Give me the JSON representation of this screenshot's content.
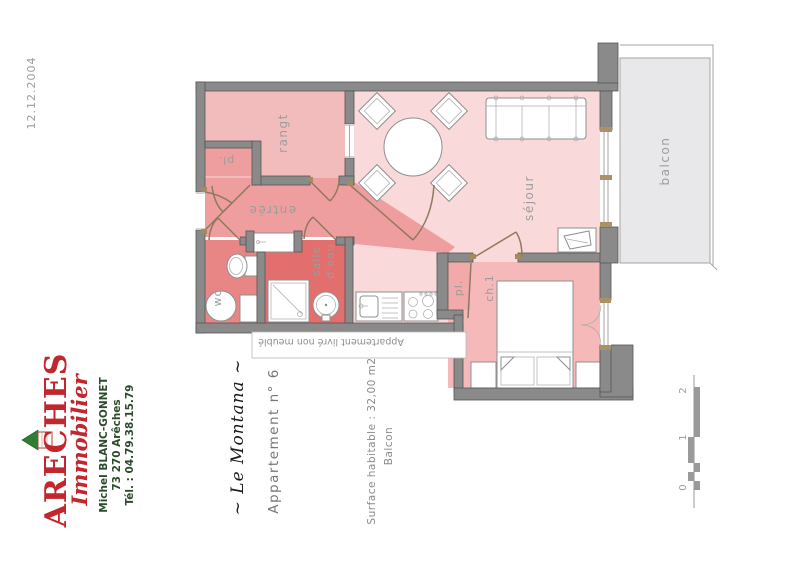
{
  "document": {
    "date": "12.12.2004",
    "delivery_note": "Appartement livré non meublé"
  },
  "agency": {
    "name": "ARECHES",
    "name_sub": "Immobilier",
    "contact": {
      "name": "Michel BLANC-GONNET",
      "city": "73 270 Arêches",
      "phone": "Tél. : 04.79.38.15.79"
    },
    "colors": {
      "brand_red": "#c1272d",
      "brand_green": "#2c4a2c"
    }
  },
  "listing": {
    "residence": "~ Le Montana ~",
    "apartment": "Appartement n° 6",
    "surface": "Surface habitable : 32,00 m2",
    "balcony": "Balcon"
  },
  "plan": {
    "rooms": [
      {
        "id": "sejour",
        "label": "séjour"
      },
      {
        "id": "rangt",
        "label": "rangt"
      },
      {
        "id": "entree",
        "label": "entrée"
      },
      {
        "id": "placard-entree",
        "label": "pl."
      },
      {
        "id": "wc",
        "label": "wc"
      },
      {
        "id": "salle-deau",
        "label": "salle d'eau",
        "line1": "salle",
        "line2": "d'eau"
      },
      {
        "id": "chambre",
        "label": "ch.1"
      },
      {
        "id": "placard-chambre",
        "label": "pl."
      },
      {
        "id": "balcon",
        "label": "balcon"
      }
    ],
    "colors": {
      "wall": "#8a8a8a",
      "sejour": "#f9d9d9",
      "rangt": "#f3bcbc",
      "entree": "#ee9e9e",
      "wc": "#e88686",
      "salle_deau": "#e26e6e",
      "chambre": "#f5b9b9",
      "placard": "#f1a9a9",
      "balcon": "#e8e8ea",
      "door": "#8f7a5f"
    },
    "scale_bar": {
      "labels": [
        "0",
        "1",
        "2"
      ]
    }
  }
}
